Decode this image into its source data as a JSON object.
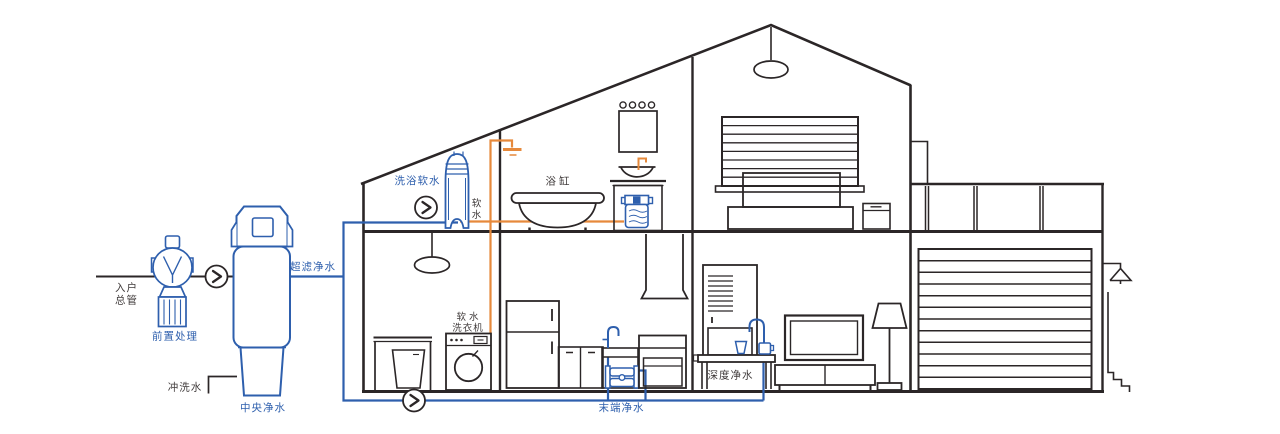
{
  "colors": {
    "pipe_blue": "#2e5fad",
    "pipe_orange": "#e6893b",
    "line_dark": "#2b2627",
    "text_dark": "#403b3b",
    "background": "#ffffff"
  },
  "labels": {
    "inlet_line1": "入户",
    "inlet_line2": "总管",
    "pre_treatment": "前置处理",
    "flush_water": "冲洗水",
    "central_purifier": "中央净水",
    "ultrafiltration": "超滤净水",
    "bath_soft_water": "洗浴软水",
    "soft_water_vertical": "软水",
    "bathtub": "浴缸",
    "washer_line1": "软水",
    "washer_line2": "洗衣机",
    "terminal_purifier": "末端净水",
    "deep_purifier": "深度净水"
  }
}
